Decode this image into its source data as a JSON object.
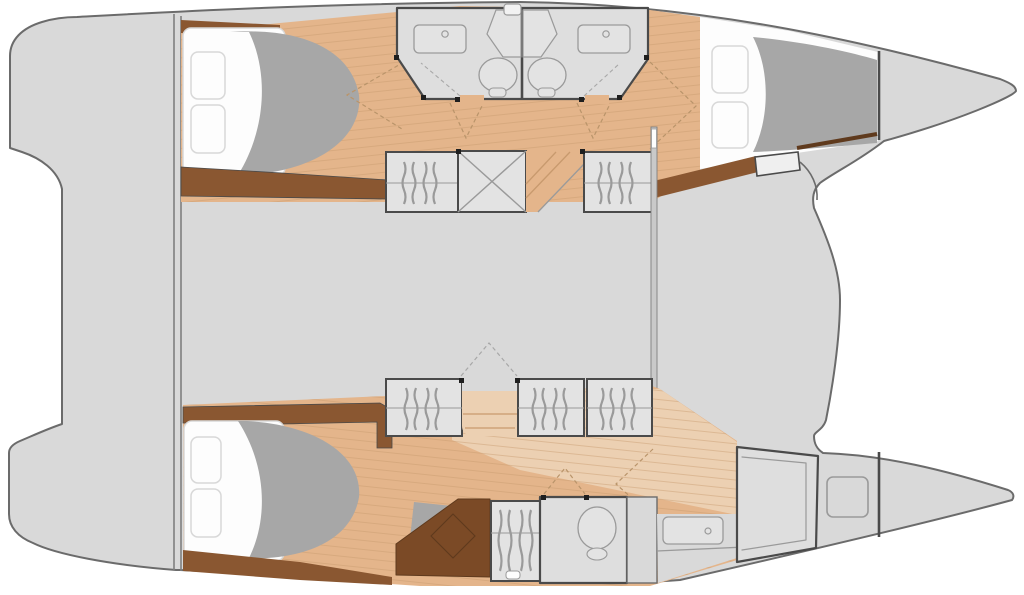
{
  "diagram": {
    "type": "catamaran-interior-floor-plan",
    "text_labels": []
  },
  "colors": {
    "page_bg": "#ffffff",
    "hull": "#d9d9d9",
    "hull_outline": "#6b6b6b",
    "stern_line": "#7f7f7f",
    "wall": "#4a4a4a",
    "wood_trim": "#8a5731",
    "wood_dark": "#7b4a26",
    "wood_line": "#5f3a1d",
    "floor": "#e4b58b",
    "floor_light": "#ecd0b2",
    "plank": "#c89a6e",
    "fixture_fill": "#e3e3e3",
    "fixture_line": "#9a9a9a",
    "room_fill": "#dedede",
    "duvet": "#a7a7a7",
    "mattress": "#fdfdfd",
    "mattress_line": "#d8d8d8",
    "swing_dash": "#b9946a",
    "swing_dash_gray": "#a8a8a8",
    "hinge": "#1f1f1f",
    "mast": "#c9c9c9"
  }
}
